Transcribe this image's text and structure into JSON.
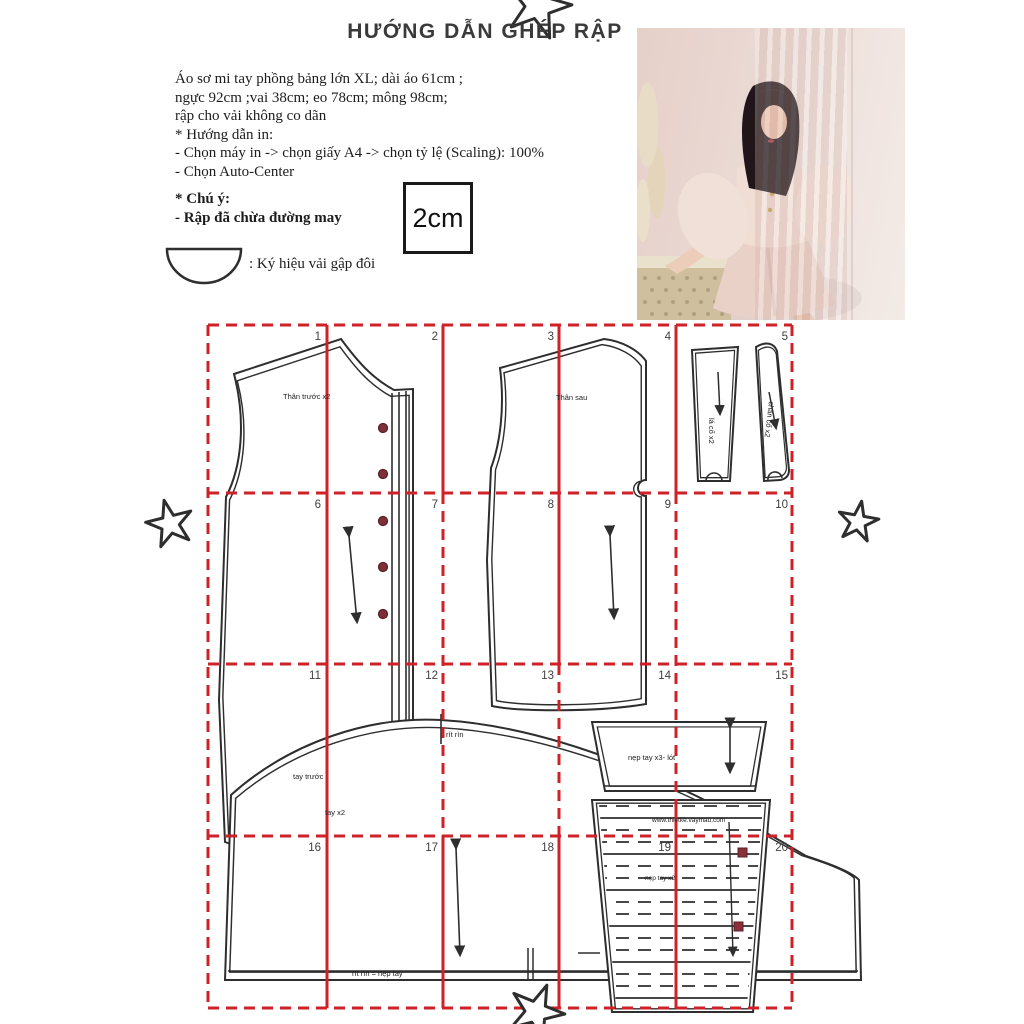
{
  "page": {
    "title": "HƯỚNG DẪN GHÉP RẬP"
  },
  "info": {
    "lines": [
      "Áo sơ mi tay phồng bảng lớn XL; dài áo 61cm ;",
      "ngực 92cm ;vai 38cm; eo 78cm; mông 98cm;",
      "rập cho vải không co dãn"
    ],
    "print_heading": "* Hướng dẫn in:",
    "print_steps": [
      "- Chọn máy in -> chọn giấy A4 -> chọn tỷ lệ (Scaling): 100%",
      "- Chọn Auto-Center"
    ],
    "note_heading": "* Chú ý:",
    "note_line": "- Rập đã chừa đường may",
    "fold_symbol_label": ": Ký hiệu vải gập đôi",
    "scale_box_label": "2cm"
  },
  "grid": {
    "numbers": [
      "1",
      "2",
      "3",
      "4",
      "5",
      "6",
      "7",
      "8",
      "9",
      "10",
      "11",
      "12",
      "13",
      "14",
      "15",
      "16",
      "17",
      "18",
      "19",
      "20"
    ]
  },
  "pieces": {
    "front_label": "Thân trước x2",
    "back_label": "Thân sau",
    "collar_leaf_label": "lá cổ x2",
    "collar_stand_label": "chân cổ x2",
    "sleeve_front_label": "tay trước",
    "sleeve_label": "tay x2",
    "sleeve_cap_mark": "rít rìn",
    "sleeve_hem_mark": "rít rìn = nẹp tay",
    "cuff_facing_label": "nẹp tay x3- lót",
    "cuff_label": "nẹp tay x2",
    "watermark": "www.thietke.vaymau.com"
  },
  "colors": {
    "grid_red": "#cf2128",
    "button_maroon": "#7e2f38",
    "line_black": "#2e2e2e",
    "photo_blush": "#f0ddd3"
  }
}
